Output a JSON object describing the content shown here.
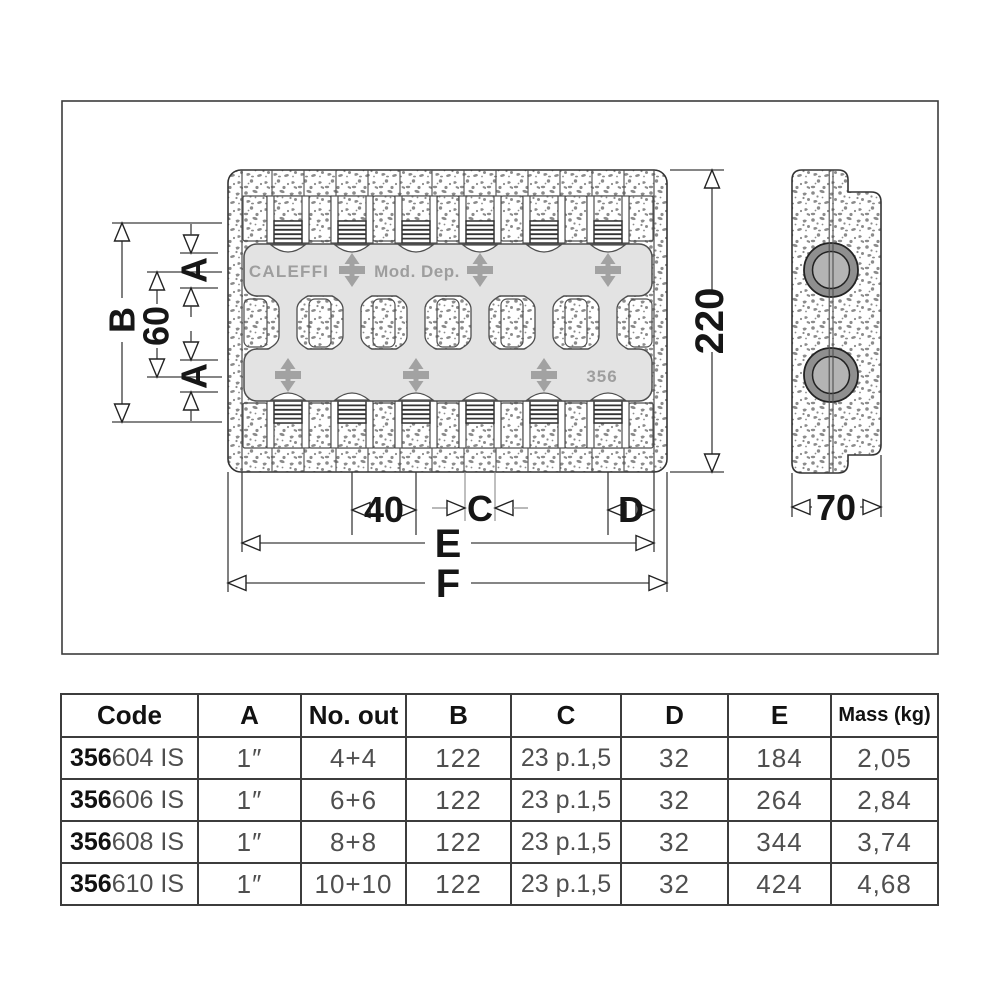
{
  "drawing": {
    "brand": {
      "caleffi": "CALEFFI",
      "mod_dep": "Mod. Dep.",
      "series": "356"
    },
    "dims": {
      "b": "B",
      "sixty": "60",
      "a_top": "A",
      "a_bottom": "A",
      "height": "220",
      "forty": "40",
      "c": "C",
      "d": "D",
      "e": "E",
      "f": "F",
      "depth": "70"
    },
    "colors": {
      "line": "#3c3c3c",
      "bar_fill": "#e3e3e3",
      "brand_gray": "#9e9e9e",
      "stipple_dot": "#8b8b8b",
      "symbol_gray": "#a2a2a2",
      "table_text": "#4f4f4f"
    }
  },
  "table": {
    "headers": [
      "Code",
      "A",
      "No. out",
      "B",
      "C",
      "D",
      "E",
      "Mass (kg)"
    ],
    "rows": [
      {
        "code_bold": "356",
        "code_rest": "604 IS",
        "a": "1″",
        "no_out": "4+4",
        "b": "122",
        "c": "23 p.1,5",
        "d": "32",
        "e": "184",
        "mass": "2,05"
      },
      {
        "code_bold": "356",
        "code_rest": "606 IS",
        "a": "1″",
        "no_out": "6+6",
        "b": "122",
        "c": "23 p.1,5",
        "d": "32",
        "e": "264",
        "mass": "2,84"
      },
      {
        "code_bold": "356",
        "code_rest": "608 IS",
        "a": "1″",
        "no_out": "8+8",
        "b": "122",
        "c": "23 p.1,5",
        "d": "32",
        "e": "344",
        "mass": "3,74"
      },
      {
        "code_bold": "356",
        "code_rest": "610 IS",
        "a": "1″",
        "no_out": "10+10",
        "b": "122",
        "c": "23 p.1,5",
        "d": "32",
        "e": "424",
        "mass": "4,68"
      }
    ]
  }
}
